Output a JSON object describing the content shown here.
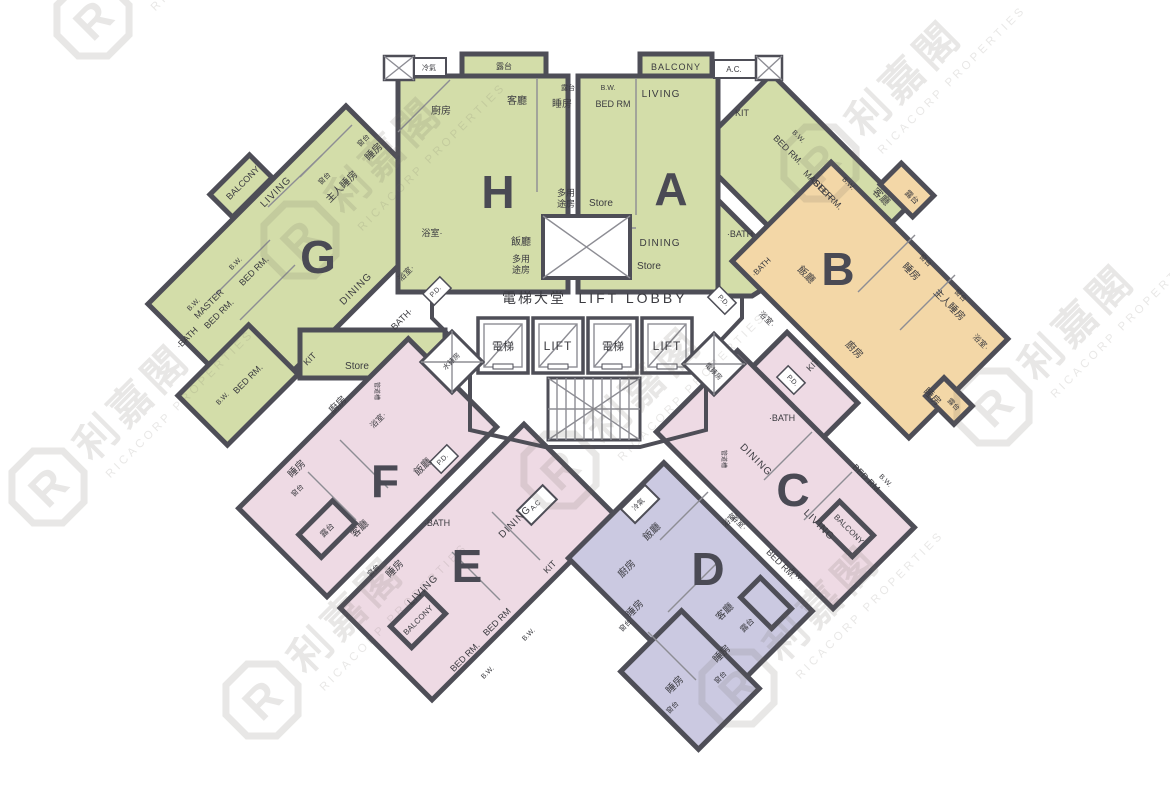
{
  "plan": {
    "title": "residential-floor-plan",
    "palette": {
      "wall": "#4e4e57",
      "green": "#d3dda9",
      "orange": "#f3d7a7",
      "pink": "#eedae4",
      "purple": "#cbc9e1",
      "label_text": "#3b3b40",
      "watermark": "#6b675e"
    }
  },
  "watermark": {
    "logo_letter": "R",
    "cn": "利嘉閣",
    "en": "RICACORP PROPERTIES",
    "instances": [
      {
        "x": 93,
        "y": 20
      },
      {
        "x": 300,
        "y": 240
      },
      {
        "x": 820,
        "y": 163
      },
      {
        "x": 993,
        "y": 407
      },
      {
        "x": 48,
        "y": 487
      },
      {
        "x": 262,
        "y": 700
      },
      {
        "x": 560,
        "y": 470
      },
      {
        "x": 738,
        "y": 688
      }
    ]
  },
  "core": {
    "labels": [
      {
        "t": "電梯大堂",
        "x": 534,
        "y": 303,
        "s": 14,
        "ls": 2
      },
      {
        "t": "LIFT LOBBY",
        "x": 633,
        "y": 303,
        "s": 14,
        "ls": 3
      },
      {
        "t": "電梯",
        "x": 503,
        "y": 350,
        "s": 11
      },
      {
        "t": "LIFT",
        "x": 558,
        "y": 350,
        "s": 12,
        "ls": 1
      },
      {
        "t": "電梯",
        "x": 613,
        "y": 350,
        "s": 11
      },
      {
        "t": "LIFT",
        "x": 667,
        "y": 350,
        "s": 12,
        "ls": 1
      },
      {
        "t": "水錶房",
        "x": 453,
        "y": 363,
        "s": 7,
        "r": -45
      },
      {
        "t": "電錶房",
        "x": 712,
        "y": 373,
        "s": 7,
        "r": 45
      }
    ]
  },
  "units": [
    {
      "id": "H",
      "letter": "H",
      "lx": 498,
      "ly": 208,
      "color": "#d3dda9",
      "rooms": [
        {
          "t": "冷氣",
          "x": 429,
          "y": 70,
          "s": 7
        },
        {
          "t": "露台",
          "x": 504,
          "y": 69,
          "s": 8
        },
        {
          "t": "客廳",
          "x": 517,
          "y": 104,
          "s": 10
        },
        {
          "t": "廚房",
          "x": 441,
          "y": 114,
          "s": 10
        },
        {
          "t": "露台",
          "x": 568,
          "y": 90,
          "s": 7
        },
        {
          "t": "睡房",
          "x": 562,
          "y": 107,
          "s": 10
        },
        {
          "t": "多用",
          "x": 566,
          "y": 196,
          "s": 9
        },
        {
          "t": "途房",
          "x": 566,
          "y": 207,
          "s": 9
        },
        {
          "t": "Store",
          "x": 601,
          "y": 206,
          "s": 10
        },
        {
          "t": "浴室·",
          "x": 432,
          "y": 236,
          "s": 9
        },
        {
          "t": "飯廳",
          "x": 521,
          "y": 245,
          "s": 10
        },
        {
          "t": "多用",
          "x": 521,
          "y": 262,
          "s": 9
        },
        {
          "t": "途房",
          "x": 521,
          "y": 273,
          "s": 9
        },
        {
          "t": "P.D.",
          "x": 437,
          "y": 293,
          "s": 7,
          "r": -45
        }
      ]
    },
    {
      "id": "A",
      "letter": "A",
      "lx": 671,
      "ly": 205,
      "color": "#d3dda9",
      "rooms": [
        {
          "t": "BALCONY",
          "x": 676,
          "y": 70,
          "s": 9,
          "ls": 1
        },
        {
          "t": "A.C.",
          "x": 734,
          "y": 72,
          "s": 8
        },
        {
          "t": "B.W.",
          "x": 608,
          "y": 90,
          "s": 7
        },
        {
          "t": "BED RM",
          "x": 613,
          "y": 107,
          "s": 9
        },
        {
          "t": "LIVING",
          "x": 661,
          "y": 97,
          "s": 10,
          "ls": 1
        },
        {
          "t": "KIT",
          "x": 742,
          "y": 116,
          "s": 9
        },
        {
          "t": "B.W.",
          "x": 797,
          "y": 138,
          "s": 7,
          "r": 45
        },
        {
          "t": "BED RM.",
          "x": 786,
          "y": 152,
          "s": 9,
          "r": 45
        },
        {
          "t": "MASTER",
          "x": 816,
          "y": 187,
          "s": 9,
          "r": 45
        },
        {
          "t": "BED RM.",
          "x": 826,
          "y": 197,
          "s": 9,
          "r": 45
        },
        {
          "t": "B.W.",
          "x": 847,
          "y": 185,
          "s": 7,
          "r": 45
        },
        {
          "t": "·BATH",
          "x": 740,
          "y": 237,
          "s": 9
        },
        {
          "t": "DINING",
          "x": 660,
          "y": 246,
          "s": 10,
          "ls": 1
        },
        {
          "t": "Store",
          "x": 649,
          "y": 269,
          "s": 10
        },
        {
          "t": "·BATH",
          "x": 763,
          "y": 269,
          "s": 8,
          "r": -45
        },
        {
          "t": "P.D.",
          "x": 722,
          "y": 302,
          "s": 7,
          "r": 45
        }
      ]
    },
    {
      "id": "G",
      "letter": "G",
      "lx": 318,
      "ly": 273,
      "color": "#d3dda9",
      "rooms": [
        {
          "t": "BALCONY",
          "x": 245,
          "y": 185,
          "s": 9,
          "r": -45
        },
        {
          "t": "LIVING",
          "x": 278,
          "y": 194,
          "s": 10,
          "r": -45,
          "ls": 1
        },
        {
          "t": "窗台",
          "x": 326,
          "y": 180,
          "s": 7,
          "r": -45
        },
        {
          "t": "主人睡房",
          "x": 344,
          "y": 189,
          "s": 10,
          "r": -45
        },
        {
          "t": "窗台",
          "x": 365,
          "y": 142,
          "s": 7,
          "r": -45
        },
        {
          "t": "睡房",
          "x": 376,
          "y": 154,
          "s": 10,
          "r": -45
        },
        {
          "t": "浴室·",
          "x": 408,
          "y": 275,
          "s": 8,
          "r": -45
        },
        {
          "t": "DINING",
          "x": 358,
          "y": 291,
          "s": 10,
          "r": -45,
          "ls": 1
        },
        {
          "t": "B.W.",
          "x": 237,
          "y": 265,
          "s": 7,
          "r": -45
        },
        {
          "t": "BED RM.",
          "x": 256,
          "y": 273,
          "s": 9,
          "r": -45
        },
        {
          "t": "B.W.",
          "x": 195,
          "y": 306,
          "s": 7,
          "r": -45
        },
        {
          "t": "MASTER",
          "x": 211,
          "y": 306,
          "s": 9,
          "r": -45
        },
        {
          "t": "BED RM.",
          "x": 221,
          "y": 316,
          "s": 9,
          "r": -45
        },
        {
          "t": "·BATH",
          "x": 189,
          "y": 340,
          "s": 9,
          "r": -45
        },
        {
          "t": "BED RM.",
          "x": 250,
          "y": 381,
          "s": 9,
          "r": -45
        },
        {
          "t": "B.W.",
          "x": 224,
          "y": 400,
          "s": 7,
          "r": -45
        },
        {
          "t": "KIT",
          "x": 312,
          "y": 361,
          "s": 9,
          "r": -45
        },
        {
          "t": "Store",
          "x": 357,
          "y": 369,
          "s": 10
        },
        {
          "t": "BATH·",
          "x": 404,
          "y": 321,
          "s": 9,
          "r": -45
        }
      ]
    },
    {
      "id": "B",
      "letter": "B",
      "lx": 838,
      "ly": 285,
      "color": "#f3d7a7",
      "rooms": [
        {
          "t": "客廳",
          "x": 879,
          "y": 199,
          "s": 10,
          "r": 45
        },
        {
          "t": "露台",
          "x": 910,
          "y": 199,
          "s": 8,
          "r": 45
        },
        {
          "t": "飯廳",
          "x": 804,
          "y": 277,
          "s": 10,
          "r": 45
        },
        {
          "t": "睡房",
          "x": 909,
          "y": 274,
          "s": 10,
          "r": 45
        },
        {
          "t": "窗台",
          "x": 924,
          "y": 262,
          "s": 7,
          "r": 45
        },
        {
          "t": "主人睡房",
          "x": 947,
          "y": 307,
          "s": 10,
          "r": 45
        },
        {
          "t": "窗台",
          "x": 959,
          "y": 297,
          "s": 7,
          "r": 45
        },
        {
          "t": "浴室·",
          "x": 765,
          "y": 321,
          "s": 8,
          "r": 45
        },
        {
          "t": "廚房",
          "x": 852,
          "y": 352,
          "s": 10,
          "r": 45
        },
        {
          "t": "浴室·",
          "x": 979,
          "y": 344,
          "s": 8,
          "r": 45
        },
        {
          "t": "睡房",
          "x": 930,
          "y": 399,
          "s": 10,
          "r": 45
        },
        {
          "t": "露台",
          "x": 952,
          "y": 406,
          "s": 7,
          "r": 45
        }
      ]
    },
    {
      "id": "F",
      "letter": "F",
      "lx": 385,
      "ly": 497,
      "color": "#eedae4",
      "rooms": [
        {
          "t": "廚房",
          "x": 340,
          "y": 407,
          "s": 10,
          "r": -45
        },
        {
          "t": "浴室·",
          "x": 380,
          "y": 422,
          "s": 8,
          "r": -45
        },
        {
          "t": "管道槽",
          "x": 375,
          "y": 391,
          "s": 6,
          "r": 90
        },
        {
          "t": "飯廳",
          "x": 425,
          "y": 469,
          "s": 10,
          "r": -45
        },
        {
          "t": "P.D.",
          "x": 444,
          "y": 461,
          "s": 7,
          "r": -45
        },
        {
          "t": "睡房",
          "x": 299,
          "y": 471,
          "s": 10,
          "r": -45
        },
        {
          "t": "窗台",
          "x": 299,
          "y": 492,
          "s": 7,
          "r": -45
        },
        {
          "t": "露台",
          "x": 329,
          "y": 532,
          "s": 8,
          "r": -45
        },
        {
          "t": "客廳",
          "x": 362,
          "y": 531,
          "s": 10,
          "r": -45
        },
        {
          "t": "窗台",
          "x": 375,
          "y": 572,
          "s": 7,
          "r": -45
        },
        {
          "t": "睡房",
          "x": 397,
          "y": 571,
          "s": 10,
          "r": -45
        }
      ]
    },
    {
      "id": "E",
      "letter": "E",
      "lx": 467,
      "ly": 582,
      "color": "#eedae4",
      "rooms": [
        {
          "t": "·BATH",
          "x": 437,
          "y": 526,
          "s": 9
        },
        {
          "t": "DINING",
          "x": 517,
          "y": 524,
          "s": 10,
          "r": -45,
          "ls": 1
        },
        {
          "t": "A.C",
          "x": 537,
          "y": 507,
          "s": 7,
          "r": -45
        },
        {
          "t": "KIT",
          "x": 552,
          "y": 569,
          "s": 9,
          "r": -45
        },
        {
          "t": "LIVING",
          "x": 425,
          "y": 592,
          "s": 10,
          "r": -45,
          "ls": 1
        },
        {
          "t": "BALCONY",
          "x": 420,
          "y": 622,
          "s": 8,
          "r": -45
        },
        {
          "t": "BED RM",
          "x": 499,
          "y": 624,
          "s": 9,
          "r": -45
        },
        {
          "t": "B.W.",
          "x": 530,
          "y": 636,
          "s": 7,
          "r": -45
        },
        {
          "t": "BED RM.",
          "x": 467,
          "y": 659,
          "s": 9,
          "r": -45
        },
        {
          "t": "B.W.",
          "x": 489,
          "y": 674,
          "s": 7,
          "r": -45
        }
      ]
    },
    {
      "id": "C",
      "letter": "C",
      "lx": 793,
      "ly": 506,
      "color": "#eedae4",
      "rooms": [
        {
          "t": "KIT",
          "x": 815,
          "y": 367,
          "s": 9,
          "r": -45
        },
        {
          "t": "P.D.",
          "x": 791,
          "y": 382,
          "s": 7,
          "r": 45
        },
        {
          "t": "·BATH",
          "x": 782,
          "y": 421,
          "s": 9
        },
        {
          "t": "管道槽",
          "x": 722,
          "y": 459,
          "s": 6,
          "r": 90
        },
        {
          "t": "DINING",
          "x": 754,
          "y": 462,
          "s": 10,
          "r": 45,
          "ls": 1
        },
        {
          "t": "BED RM.",
          "x": 865,
          "y": 481,
          "s": 9,
          "r": 45
        },
        {
          "t": "B.W.",
          "x": 884,
          "y": 482,
          "s": 7,
          "r": 45
        },
        {
          "t": "浴室·",
          "x": 737,
          "y": 524,
          "s": 8,
          "r": 45
        },
        {
          "t": "LIVING",
          "x": 817,
          "y": 527,
          "s": 10,
          "r": 45,
          "ls": 1
        },
        {
          "t": "BALCONY",
          "x": 847,
          "y": 531,
          "s": 8,
          "r": 45
        },
        {
          "t": "BED RM.",
          "x": 779,
          "y": 566,
          "s": 9,
          "r": 45
        },
        {
          "t": "B.W.",
          "x": 795,
          "y": 576,
          "s": 7,
          "r": 45
        }
      ]
    },
    {
      "id": "D",
      "letter": "D",
      "lx": 708,
      "ly": 585,
      "color": "#cbc9e1",
      "rooms": [
        {
          "t": "冷氣",
          "x": 640,
          "y": 506,
          "s": 7,
          "r": -45
        },
        {
          "t": "飯廳",
          "x": 654,
          "y": 534,
          "s": 10,
          "r": -45
        },
        {
          "t": "廚房",
          "x": 629,
          "y": 571,
          "s": 10,
          "r": -45
        },
        {
          "t": "浴室·",
          "x": 732,
          "y": 521,
          "s": 8,
          "r": -45
        },
        {
          "t": "睡房",
          "x": 637,
          "y": 611,
          "s": 10,
          "r": -45
        },
        {
          "t": "窗台",
          "x": 627,
          "y": 627,
          "s": 7,
          "r": -45
        },
        {
          "t": "客廳",
          "x": 727,
          "y": 614,
          "s": 10,
          "r": -45
        },
        {
          "t": "露台",
          "x": 749,
          "y": 627,
          "s": 8,
          "r": -45
        },
        {
          "t": "睡房",
          "x": 724,
          "y": 656,
          "s": 10,
          "r": -45
        },
        {
          "t": "窗台",
          "x": 722,
          "y": 679,
          "s": 7,
          "r": -45
        },
        {
          "t": "睡房",
          "x": 677,
          "y": 687,
          "s": 10,
          "r": -45
        },
        {
          "t": "窗台",
          "x": 674,
          "y": 709,
          "s": 7,
          "r": -45
        }
      ]
    }
  ]
}
